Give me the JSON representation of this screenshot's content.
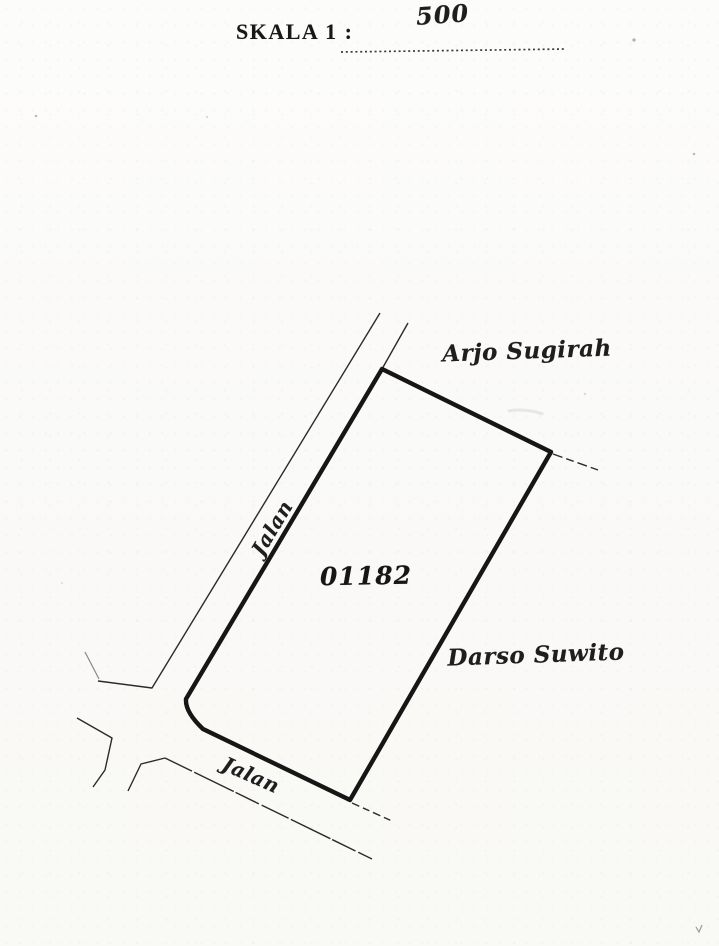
{
  "header": {
    "scale_label": "SKALA 1 :",
    "scale_value": "500"
  },
  "map": {
    "parcel_number": "01182",
    "neighbors": {
      "north": "Arjo Sugirah",
      "east": "Darso Suwito"
    },
    "roads": {
      "west_label": "Jalan",
      "south_label": "Jalan"
    },
    "colors": {
      "ink": "#1e1e1e",
      "parcel_line": "#161616",
      "paper": "#fbfbf9"
    }
  }
}
